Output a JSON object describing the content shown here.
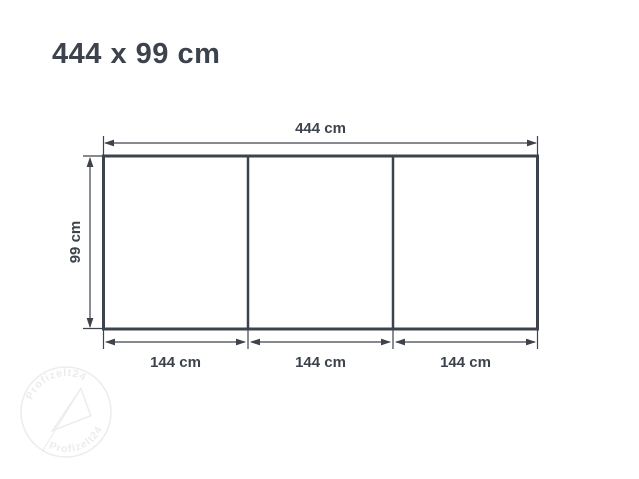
{
  "title": "444 x 99 cm",
  "diagram": {
    "width_label": "444 cm",
    "height_label": "99 cm",
    "section_labels": [
      "144 cm",
      "144 cm",
      "144 cm"
    ],
    "section_count": 3,
    "line_color": "#3d434c",
    "background_color": "#ffffff",
    "watermark": {
      "text_top": "Profizelt24",
      "text_bottom": "Profizelt24",
      "color": "#ececec"
    }
  }
}
